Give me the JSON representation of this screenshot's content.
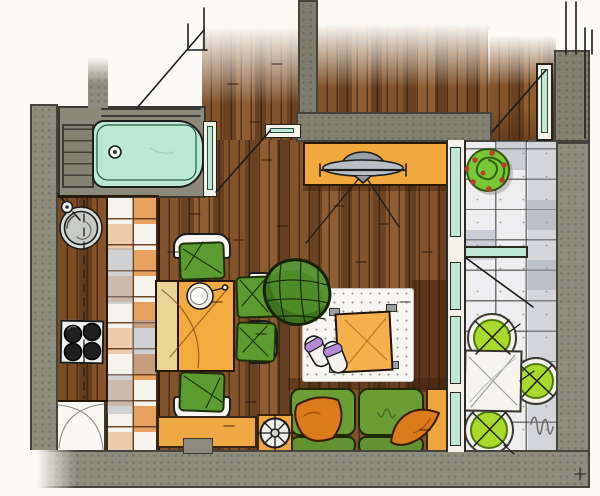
{
  "title": "Hand-drawn apartment floor plan, top-down marker sketch",
  "canvas": {
    "width": 600,
    "height": 496
  },
  "rooms": [
    {
      "name": "entry-hall",
      "floor": "wood-planks",
      "items": [
        "entry-door",
        "door-swing-line"
      ]
    },
    {
      "name": "bathroom",
      "items": [
        "bathtub",
        "bathtub-faucet",
        "storage-shelf",
        "bathroom-door"
      ]
    },
    {
      "name": "kitchen",
      "floor": "orange-white-checker-tiles",
      "items": [
        "wood-countertop",
        "round-sink",
        "soap-dish",
        "cooktop-with-4-burners",
        "base-cabinet-with-door-swing-arcs"
      ]
    },
    {
      "name": "living-dining-room",
      "floor": "wood-planks",
      "items": [
        "dining-table-with-extension-leaf",
        "fruit-bowl-with-spoon",
        "dining-chair x4 (green)",
        "armchair (green, woven)",
        "white-stippled-rug",
        "coffee-table (orange)",
        "slippers (purple)",
        "sofa (green, 2 seats)",
        "pillow x2 (orange)",
        "sofa-side-table (orange)",
        "sideboard (orange)",
        "pendant-lamp (gray)",
        "low-bench (orange)",
        "decor-plate (round)"
      ]
    },
    {
      "name": "balcony",
      "floor": "stone-tiles",
      "items": [
        "plant-with-red-berries",
        "patio-table (white)",
        "patio-chair x3 (lime, round)",
        "artist-squiggle"
      ]
    }
  ],
  "colors": {
    "paper": "#fbfaf5",
    "wall": "#8e8c7c",
    "wall_edge": "#45443a",
    "wood": "#8a5a34",
    "tile_orange": "#e7a160",
    "tile_white": "#f6f3ec",
    "glass_teal": "#bfe8d5",
    "tub_teal": "#bce9d3",
    "table_orange": "#f3aa3e",
    "table_leaf": "#ead694",
    "chair_green": "#5c9b2f",
    "armchair_green": "#4e8c27",
    "sofa_green": "#6b9d34",
    "pillow_orange": "#dc7b1b",
    "sideboard_orange": "#f1a93e",
    "coffee_table_orange": "#f4b14b",
    "rug_white": "#f7f6f1",
    "balcony_tile": "#eeeef0",
    "patio_lime": "#a9da2b",
    "plant_green": "#79c636",
    "berry_red": "#b5402c",
    "slipper_purple": "#b389d8",
    "lamp_gray": "#b9bfc4",
    "sink_gray": "#c7cac5",
    "burner_black": "#1f1f1f"
  }
}
